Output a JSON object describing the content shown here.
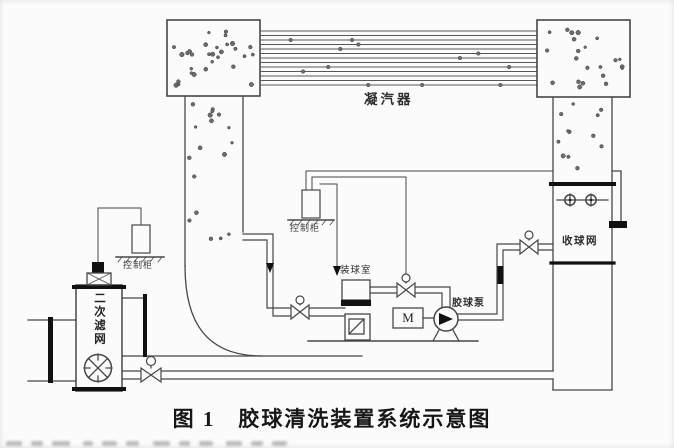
{
  "figure_caption": "图 1　胶球清洗装置系统示意图",
  "labels": {
    "condenser": "凝汽器",
    "control_cabinet_left": "控制柜",
    "control_cabinet_middle": "控制柜",
    "secondary_filter": "二次滤网",
    "ball_loading_chamber": "装球室",
    "ball_pump": "胶球泵",
    "ball_collecting_screen": "收球网",
    "motor": "M"
  }
}
